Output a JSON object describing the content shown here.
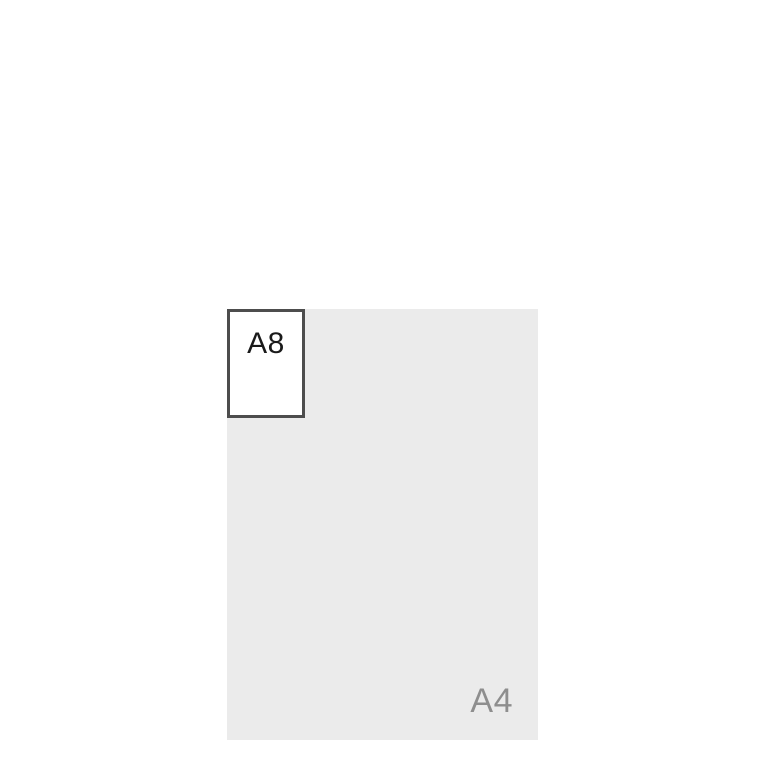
{
  "diagram": {
    "type": "paper-size-comparison",
    "sheets": [
      {
        "label": "A4",
        "fill": "#ebebeb",
        "label_color": "#8e8e8e",
        "label_position": "bottom-right"
      },
      {
        "label": "A8",
        "fill": "#ffffff",
        "border_color": "#4d4d4d",
        "label_color": "#1a1a1a",
        "label_position": "top-center",
        "placement": "top-left corner of A4"
      }
    ],
    "background": "#ffffff"
  }
}
